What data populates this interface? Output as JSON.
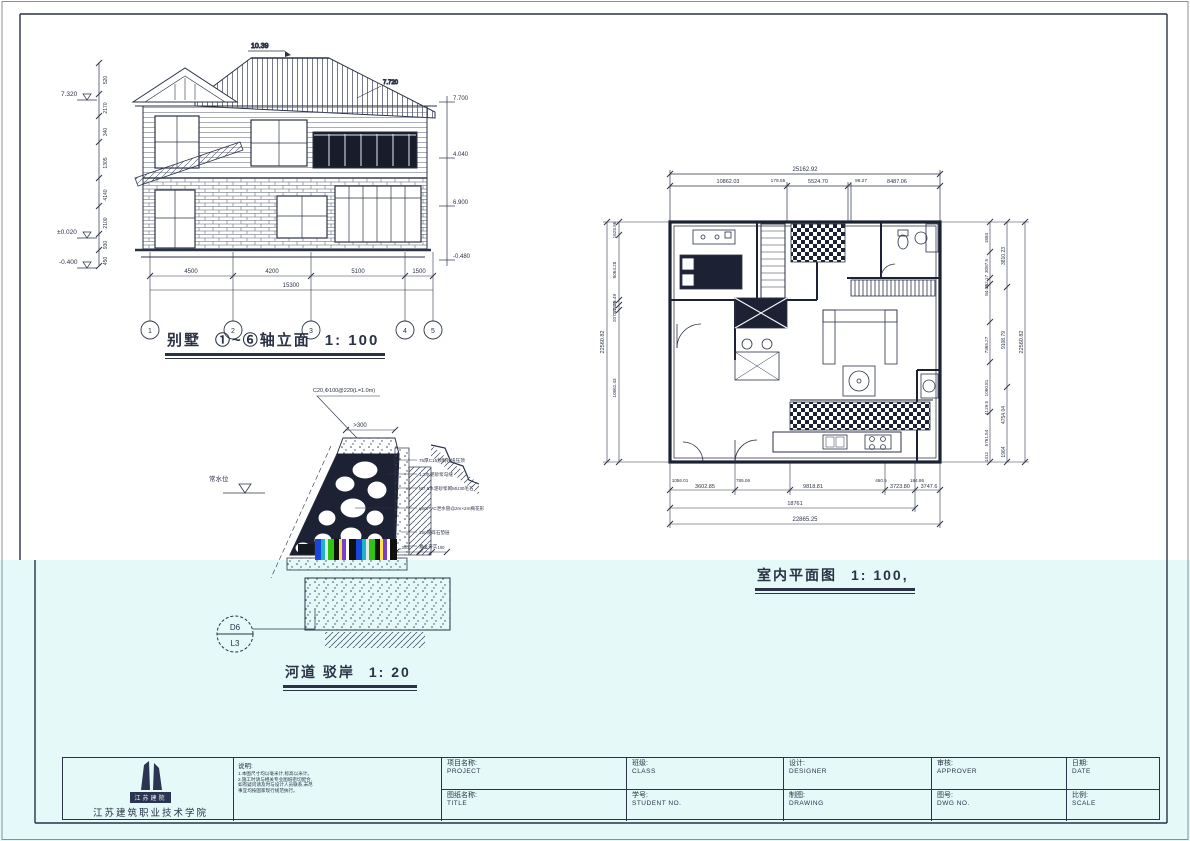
{
  "sheet": {
    "band_color": "#e4f9f8",
    "ink": "#2b3246",
    "org": "江苏建筑职业技术学院",
    "logo_banner": "江苏建院"
  },
  "elevation": {
    "name": "别墅",
    "axes_label": "①~⑥轴立面",
    "scale": "1: 100",
    "ridge_level": "10.39",
    "right_roof_level": "7.720",
    "level_top": "7.320",
    "level_zero": "±0.020",
    "level_base": "-0.400",
    "left_dims": [
      "520",
      "2170",
      "340",
      "1305",
      "4140",
      "2100",
      "930",
      "450"
    ],
    "right_levels": [
      "7.700",
      "4.040",
      "6.900",
      "-0.480"
    ],
    "bottom_dims": [
      "4500",
      "4200",
      "5100",
      "1500"
    ],
    "bottom_total": "15300",
    "axes": [
      "1",
      "2",
      "3",
      "4",
      "5"
    ]
  },
  "floorplan": {
    "title": "室内平面图",
    "scale": "1: 100,",
    "top_total": "25162.92",
    "top_dims": [
      "10862.03",
      "179.55",
      "5524.70",
      "98.27",
      "8487.06"
    ],
    "left_total": "22560.82",
    "left_dims": [
      "1628.96",
      "8064.28",
      "205.49",
      "176.26",
      "207.52",
      "10862.43"
    ],
    "right_total": "22560.82",
    "right_dims": [
      "1884",
      "3087.5",
      "162.17",
      "84.05",
      "7365.27",
      "1060.81",
      "4129.5",
      "5761.54",
      "1412"
    ],
    "right_dims_mid": [
      "3810.23",
      "9108.79",
      "4754.04",
      "1964"
    ],
    "bottom_upper_dims": [
      "1056.01",
      "785.06",
      "460.5",
      "184.86"
    ],
    "bottom_dims": [
      "3602.85",
      "9818.81",
      "3723.80",
      "3747.6"
    ],
    "bottom_mid": "18761",
    "bottom_total": "22865.25"
  },
  "detail": {
    "title": "河道 驳岸",
    "scale": "1: 20",
    "bubble_top": "D6",
    "bubble_bottom": "L3",
    "cap_note": "C20,Φ100@220(L=1.0m)",
    "cap_dim": ">300",
    "water_label": "常水位",
    "callouts": [
      "75厚C15预制砼块压顶",
      "1:2水泥砂浆勾缝",
      "M7.5水泥砂浆砌MU30毛石",
      "φ80PVC泄水管@2m×2m梅花形",
      "150厚碎石垫层",
      "素土夯实"
    ],
    "footing_dims": [
      "300",
      "50",
      "100"
    ]
  },
  "titleblock": {
    "project_cn": "项目名称:",
    "project_en": "PROJECT",
    "class_cn": "班级:",
    "class_en": "CLASS",
    "designer_cn": "设计:",
    "designer_en": "DESIGNER",
    "approver_cn": "审核:",
    "approver_en": "APPROVER",
    "date_cn": "日期:",
    "date_en": "DATE",
    "title_cn": "图纸名称:",
    "title_en": "TITLE",
    "student_cn": "学号:",
    "student_en": "STUDENT NO.",
    "drawing_cn": "制图:",
    "drawing_en": "DRAWING",
    "dwg_cn": "图号:",
    "dwg_en": "DWG NO.",
    "scale_cn": "比例:",
    "scale_en": "SCALE",
    "notes_title": "说明:",
    "notes": [
      "1.本图尺寸均以毫米计,标高以米计。",
      "2.施工时请与相关专业图纸密切配合,",
      "如有疑问请及时与设计人员联系,未尽",
      "事宜均按国家现行规范执行。"
    ]
  }
}
